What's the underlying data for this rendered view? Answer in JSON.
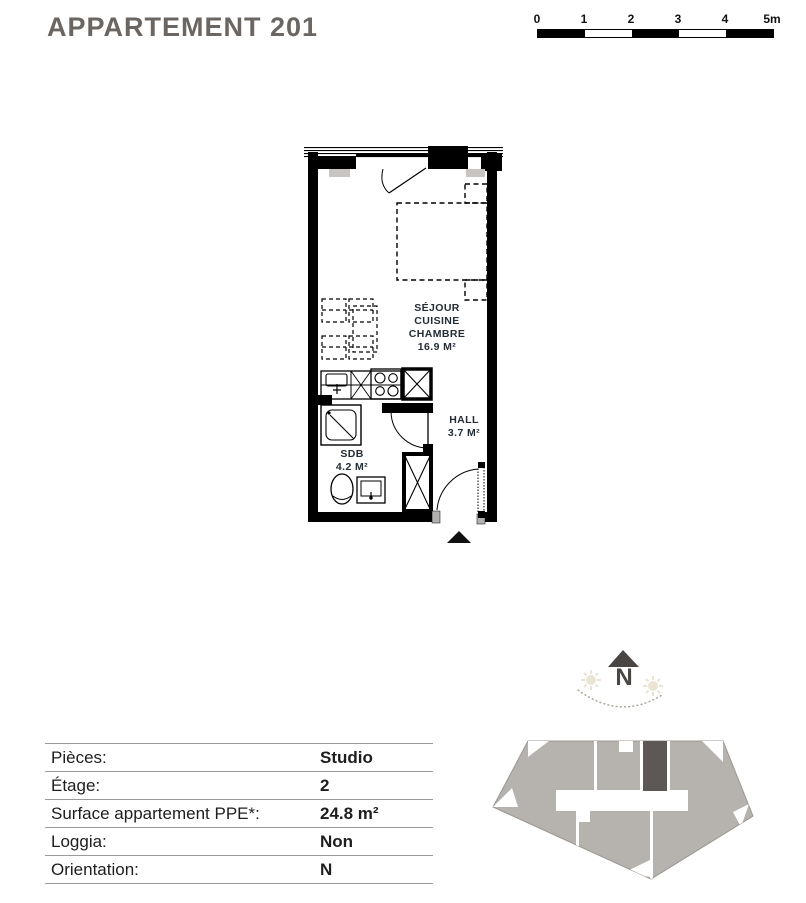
{
  "title": "APPARTEMENT 201",
  "scale_bar": {
    "tick_labels": [
      "0",
      "1",
      "2",
      "3",
      "4",
      "5m"
    ]
  },
  "floor_plan": {
    "rooms": {
      "sejour": {
        "name_lines": [
          "SÉJOUR",
          "CUISINE",
          "CHAMBRE"
        ],
        "area": "16.9 M²"
      },
      "hall": {
        "name": "HALL",
        "area": "3.7 M²"
      },
      "sdb": {
        "name": "SDB",
        "area": "4.2 M²"
      }
    }
  },
  "compass": {
    "north_label": "N"
  },
  "details_table": {
    "rows": [
      {
        "label": "Pièces:",
        "value": "Studio"
      },
      {
        "label": "Étage:",
        "value": "2"
      },
      {
        "label": "Surface appartement PPE*:",
        "value": "24.8 m²"
      },
      {
        "label": "Loggia:",
        "value": "Non"
      },
      {
        "label": "Orientation:",
        "value": "N"
      }
    ]
  },
  "colors": {
    "title_text": "#6b6661",
    "room_label_text": "#242c35",
    "table_text": "#1e1e1e",
    "table_line": "#9b9b9b",
    "wall": "#000000",
    "site_unit_fill": "#b6b2ae",
    "site_unit_highlight": "#5d5855",
    "compass_arrow": "#4a4643",
    "sun": "#ece4d2"
  }
}
